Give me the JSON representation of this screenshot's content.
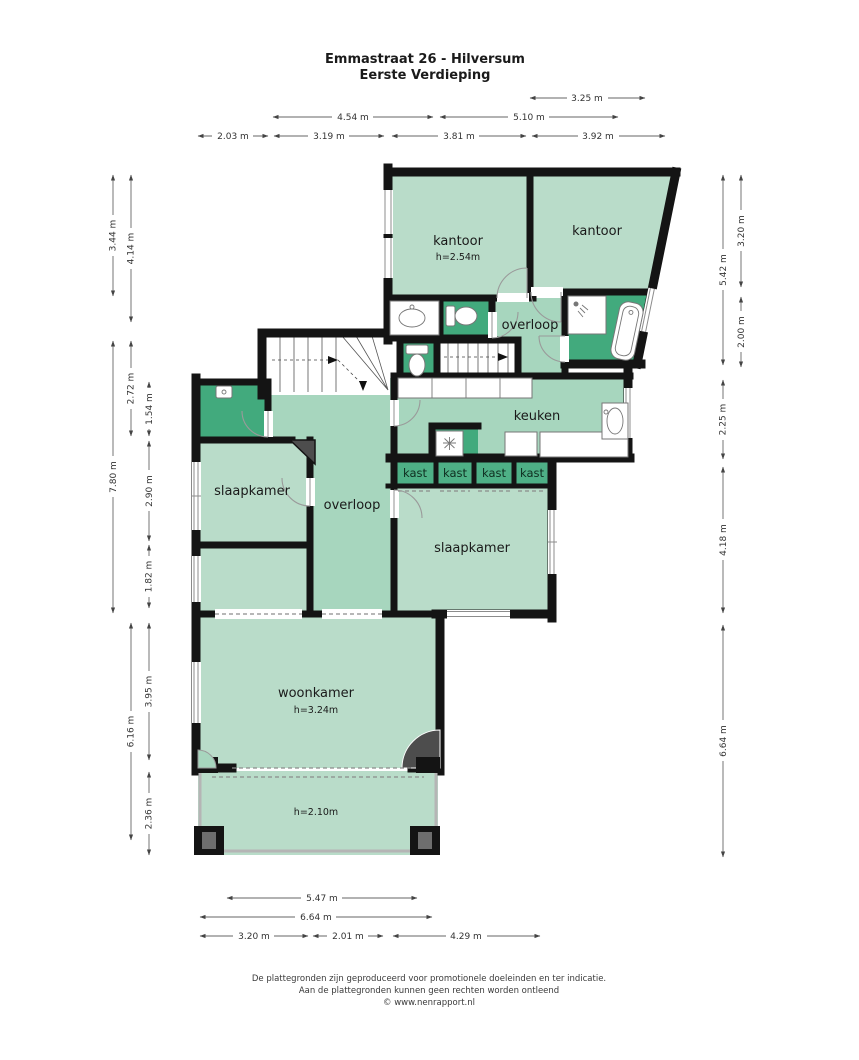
{
  "title": {
    "line1": "Emmastraat 26 - Hilversum",
    "line2": "Eerste Verdieping"
  },
  "rooms": {
    "kantoor_left": {
      "label": "kantoor",
      "ceiling": "h=2.54m"
    },
    "kantoor_right": {
      "label": "kantoor"
    },
    "overloop_boven": {
      "label": "overloop"
    },
    "keuken": {
      "label": "keuken"
    },
    "slaapkamer_links": {
      "label": "slaapkamer"
    },
    "overloop": {
      "label": "overloop"
    },
    "kast": {
      "label": "kast"
    },
    "slaapkamer_rechts": {
      "label": "slaapkamer"
    },
    "woonkamer": {
      "label": "woonkamer",
      "ceiling": "h=3.24m"
    },
    "balkon": {
      "ceiling": "h=2.10m"
    }
  },
  "dims": {
    "top": [
      "3.25 m",
      "4.54 m",
      "5.10 m",
      "2.03 m",
      "3.19 m",
      "3.81 m",
      "3.92 m"
    ],
    "left": [
      "3.44 m",
      "4.14 m",
      "2.72 m",
      "1.54 m",
      "7.80 m",
      "2.90 m",
      "1.82 m",
      "6.16 m",
      "3.95 m",
      "2.36 m"
    ],
    "right": [
      "5.42 m",
      "3.20 m",
      "2.00 m",
      "2.25 m",
      "4.18 m",
      "6.64 m"
    ],
    "bottom": [
      "5.47 m",
      "6.64 m",
      "3.20 m",
      "2.01 m",
      "4.29 m"
    ]
  },
  "footer": {
    "line1": "De plattegronden zijn geproduceerd voor promotionele doeleinden en ter indicatie.",
    "line2": "Aan de plattegronden kunnen geen rechten worden ontleend",
    "line3": "© www.nenrapport.nl"
  },
  "colors": {
    "room_light": "#b9dcc9",
    "room_medium": "#a7d6be",
    "room_dark": "#42aa7d",
    "kast_green": "#4eb086",
    "wall": "#141414"
  }
}
